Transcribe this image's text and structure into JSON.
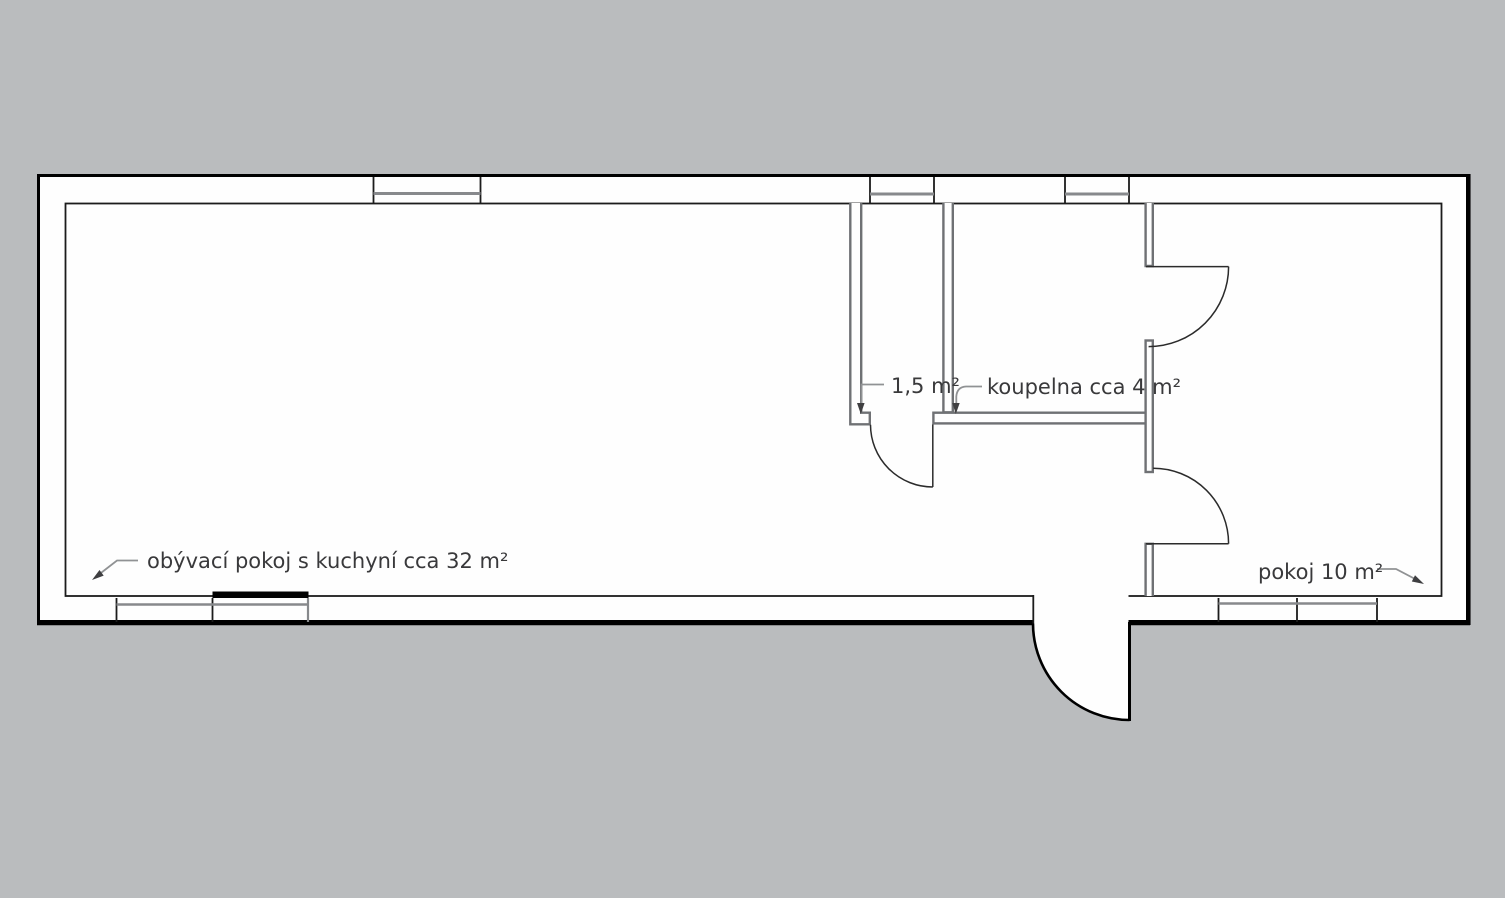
{
  "title": "Floor plan",
  "colors": {
    "bg": "#babcbe",
    "floor": "#fefefe",
    "outer": "#000000",
    "inner": "#1c1c1c",
    "partition": "#6f7174",
    "window": "#87898c",
    "door": "#2b2b2b",
    "leader": "#909294",
    "arrow": "#3f3f41",
    "label": "#39393b",
    "sill": "#010101"
  },
  "labels": {
    "wc": "1,5 m²",
    "bathroom": "koupelna cca 4 m²",
    "living": "obývací pokoj s kuchyní cca 32 m²",
    "room": "pokoj 10 m²"
  }
}
